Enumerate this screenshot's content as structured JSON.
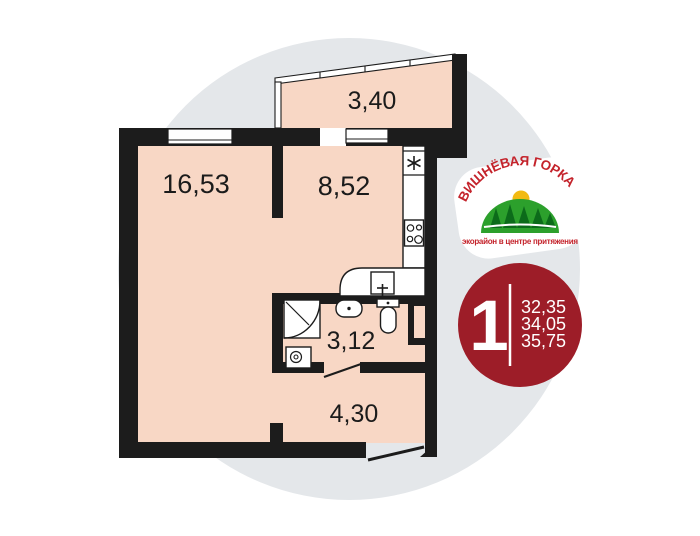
{
  "plan": {
    "rooms": [
      {
        "id": "living-room",
        "area": "16,53"
      },
      {
        "id": "kitchen",
        "area": "8,52"
      },
      {
        "id": "balcony",
        "area": "3,40"
      },
      {
        "id": "bathroom",
        "area": "3,12"
      },
      {
        "id": "hallway",
        "area": "4,30"
      }
    ]
  },
  "logo": {
    "title": "ВИШНЁВАЯ ГОРКА",
    "tagline": "экорайон в центре притяжения"
  },
  "badge": {
    "rooms_count": "1",
    "areas": [
      "32,35",
      "34,05",
      "35,75"
    ]
  },
  "colors": {
    "wall": "#1c1c1c",
    "room_fill": "#f8d7c5",
    "backdrop_circle": "#e4e7ea",
    "badge_red": "#9d1d28",
    "logo_red": "#c4232b",
    "logo_green": "#2ca02c",
    "logo_tree_green": "#0c6b1a",
    "logo_sun": "#f2ba12"
  }
}
